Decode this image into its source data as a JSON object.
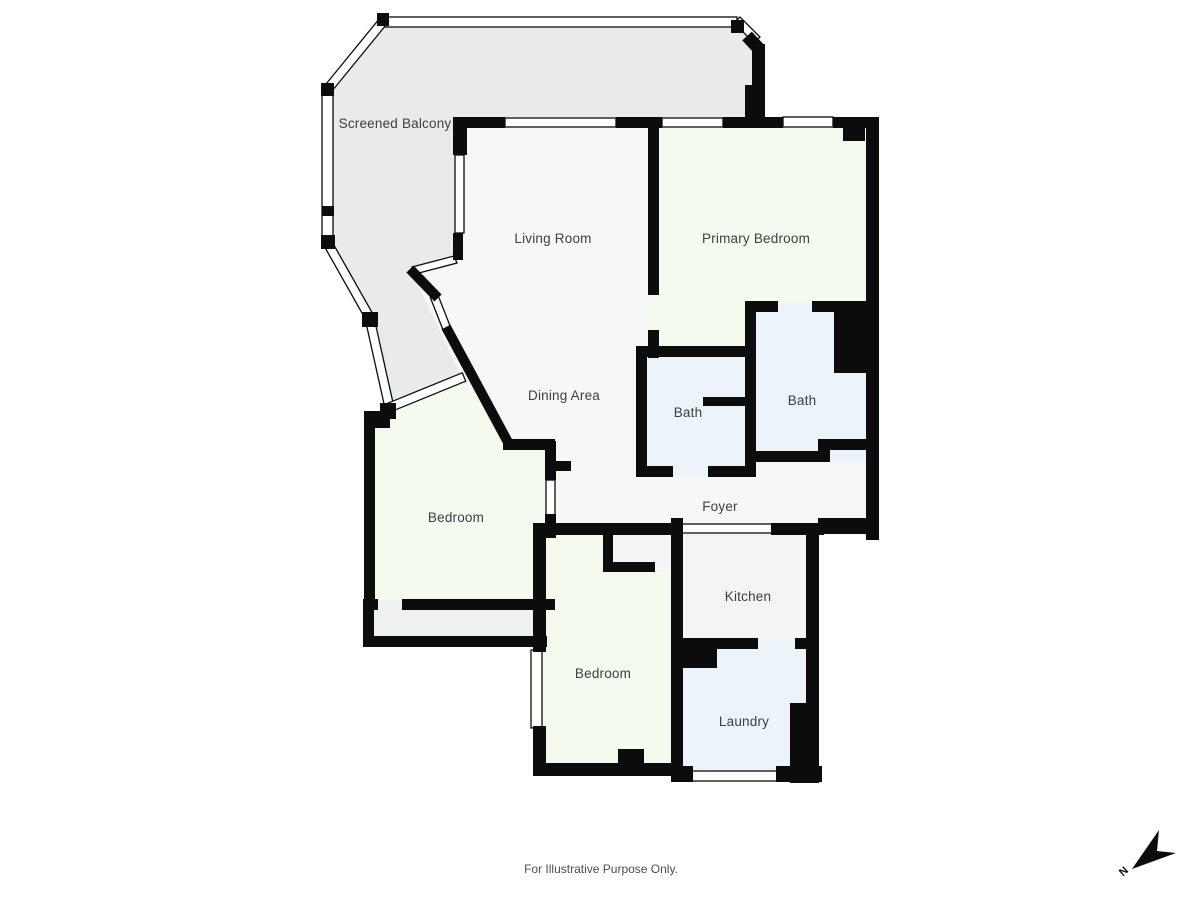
{
  "rooms": {
    "balcony": {
      "label": "Screened Balcony"
    },
    "living": {
      "label": "Living Room"
    },
    "primary": {
      "label": "Primary Bedroom"
    },
    "dining": {
      "label": "Dining Area"
    },
    "bath_left": {
      "label": "Bath"
    },
    "bath_right": {
      "label": "Bath"
    },
    "foyer": {
      "label": "Foyer"
    },
    "bedroom_left": {
      "label": "Bedroom"
    },
    "kitchen": {
      "label": "Kitchen"
    },
    "bedroom_bottom": {
      "label": "Bedroom"
    },
    "laundry": {
      "label": "Laundry"
    }
  },
  "footer": {
    "disclaimer": "For Illustrative Purpose Only."
  },
  "compass": {
    "label": "N"
  },
  "colors": {
    "wall": "#0c0c0c",
    "window_fill": "#ffffff",
    "balcony_fill": "#e9eaea",
    "room_white": "#f6f7f6",
    "kitchen_gray": "#f3f4f4",
    "closet_gray": "#f4f5f4",
    "strip_gray": "#eff0f0",
    "bedroom_green": "#f5faee",
    "bath_blue": "#ecf4fa",
    "label_text": "#3a4046",
    "footer_text": "#4a4f55"
  }
}
